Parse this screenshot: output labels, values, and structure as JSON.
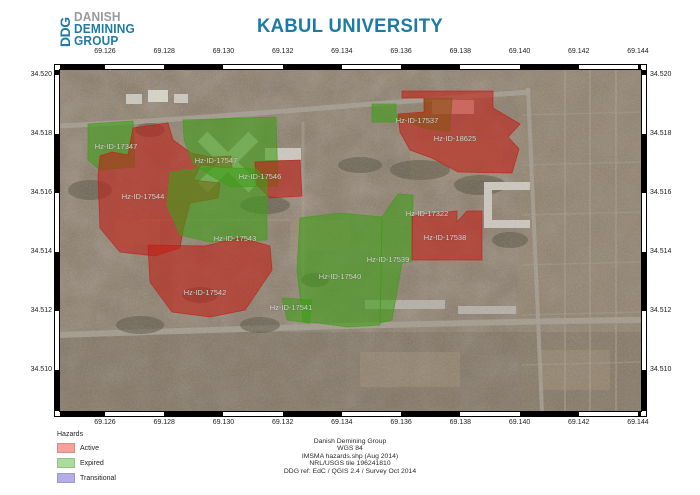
{
  "header": {
    "logo": {
      "vertical_text": "DDG",
      "line1": "DANISH",
      "line2": "DEMINING",
      "line3": "GROUP"
    },
    "title": "KABUL UNIVERSITY"
  },
  "map": {
    "x_axis_labels": [
      "69.126",
      "69.128",
      "69.130",
      "69.132",
      "69.134",
      "69.136",
      "69.138",
      "69.140",
      "69.142",
      "69.144"
    ],
    "y_axis_labels": [
      "34.520",
      "34.518",
      "34.516",
      "34.514",
      "34.512",
      "34.510"
    ],
    "status_fill": {
      "Active": "#c21d14",
      "Expired": "#3f9e17",
      "Transitional": "#7a74d8"
    },
    "hazards": [
      {
        "id": "Hz-ID-17347",
        "status": "Expired",
        "label_x": 56,
        "label_y": 76,
        "points": "28,54 73,51 75,97 40,100 28,90"
      },
      {
        "id": "Hz-ID-17544",
        "status": "Active",
        "label_x": 83,
        "label_y": 126,
        "points": "38,106 40,86 52,82 68,85 73,58 108,53 113,70 131,83 150,87 171,86 172,98 141,95 133,110 160,113 158,128 130,133 123,160 120,178 95,186 60,182 40,158"
      },
      {
        "id": "Hz-ID-17547",
        "status": "Expired",
        "label_x": 156,
        "label_y": 90,
        "points": "123,50 216,47 218,116 170,117 150,105 133,93 124,70"
      },
      {
        "id": "Hz-ID-17546",
        "status": "Active",
        "label_x": 200,
        "label_y": 106,
        "points": "195,92 240,90 242,126 210,128 196,114"
      },
      {
        "id": "Hz-ID-17543",
        "status": "Expired",
        "label_x": 175,
        "label_y": 168,
        "points": "110,102 150,97 196,99 207,109 207,170 150,172 120,165 107,135"
      },
      {
        "id": "Hz-ID-17542",
        "status": "Active",
        "label_x": 145,
        "label_y": 222,
        "points": "88,175 145,176 178,168 196,172 210,176 212,200 185,240 150,247 112,242 90,212"
      },
      {
        "id": "Hz-ID-17541",
        "status": "Expired",
        "label_x": 231,
        "label_y": 237,
        "points": "222,228 252,230 250,253 227,250"
      },
      {
        "id": "Hz-ID-17540",
        "status": "Expired",
        "label_x": 280,
        "label_y": 206,
        "points": "240,148 280,143 322,147 320,255 288,257 243,251 237,200"
      },
      {
        "id": "Hz-ID-17539",
        "status": "Expired",
        "label_x": 328,
        "label_y": 189,
        "points": "322,147 338,124 353,125 352,191 342,193 332,250 320,253"
      },
      {
        "id": "Hz-ID-17537",
        "status": "Expired",
        "label_x": 357,
        "label_y": 50,
        "points": "312,34 336,34 336,46 364,43 364,28 392,28 390,61 364,58 348,52 312,52"
      },
      {
        "id": "Hz-ID-18625",
        "status": "Active",
        "label_x": 395,
        "label_y": 68,
        "points": "342,21 433,21 433,38 460,54 448,67 459,79 452,103 398,102 372,88 350,80 340,62 338,44 364,42 364,28 342,28"
      },
      {
        "id": "Hz-ID-17322",
        "status": "Active",
        "label_x": 367,
        "label_y": 143,
        "points": ""
      },
      {
        "id": "Hz-ID-17538",
        "status": "Active",
        "label_x": 385,
        "label_y": 167,
        "points": "352,146 397,141 397,152 407,141 422,141 422,190 352,190"
      }
    ]
  },
  "legend": {
    "title": "Hazards",
    "items": [
      {
        "label": "Active",
        "swatch": "#f5a19c"
      },
      {
        "label": "Expired",
        "swatch": "#abdc9d"
      },
      {
        "label": "Transitional",
        "swatch": "#b3aeea"
      }
    ]
  },
  "credits": {
    "lines": [
      "Danish Demining Group",
      "WGS 84",
      "IMSMA hazards.shp (Aug 2014)",
      "NRL/USGS tile 196241810",
      "DDG ref: EdC / QGIS 2.4 / Survey Oct 2014"
    ]
  }
}
